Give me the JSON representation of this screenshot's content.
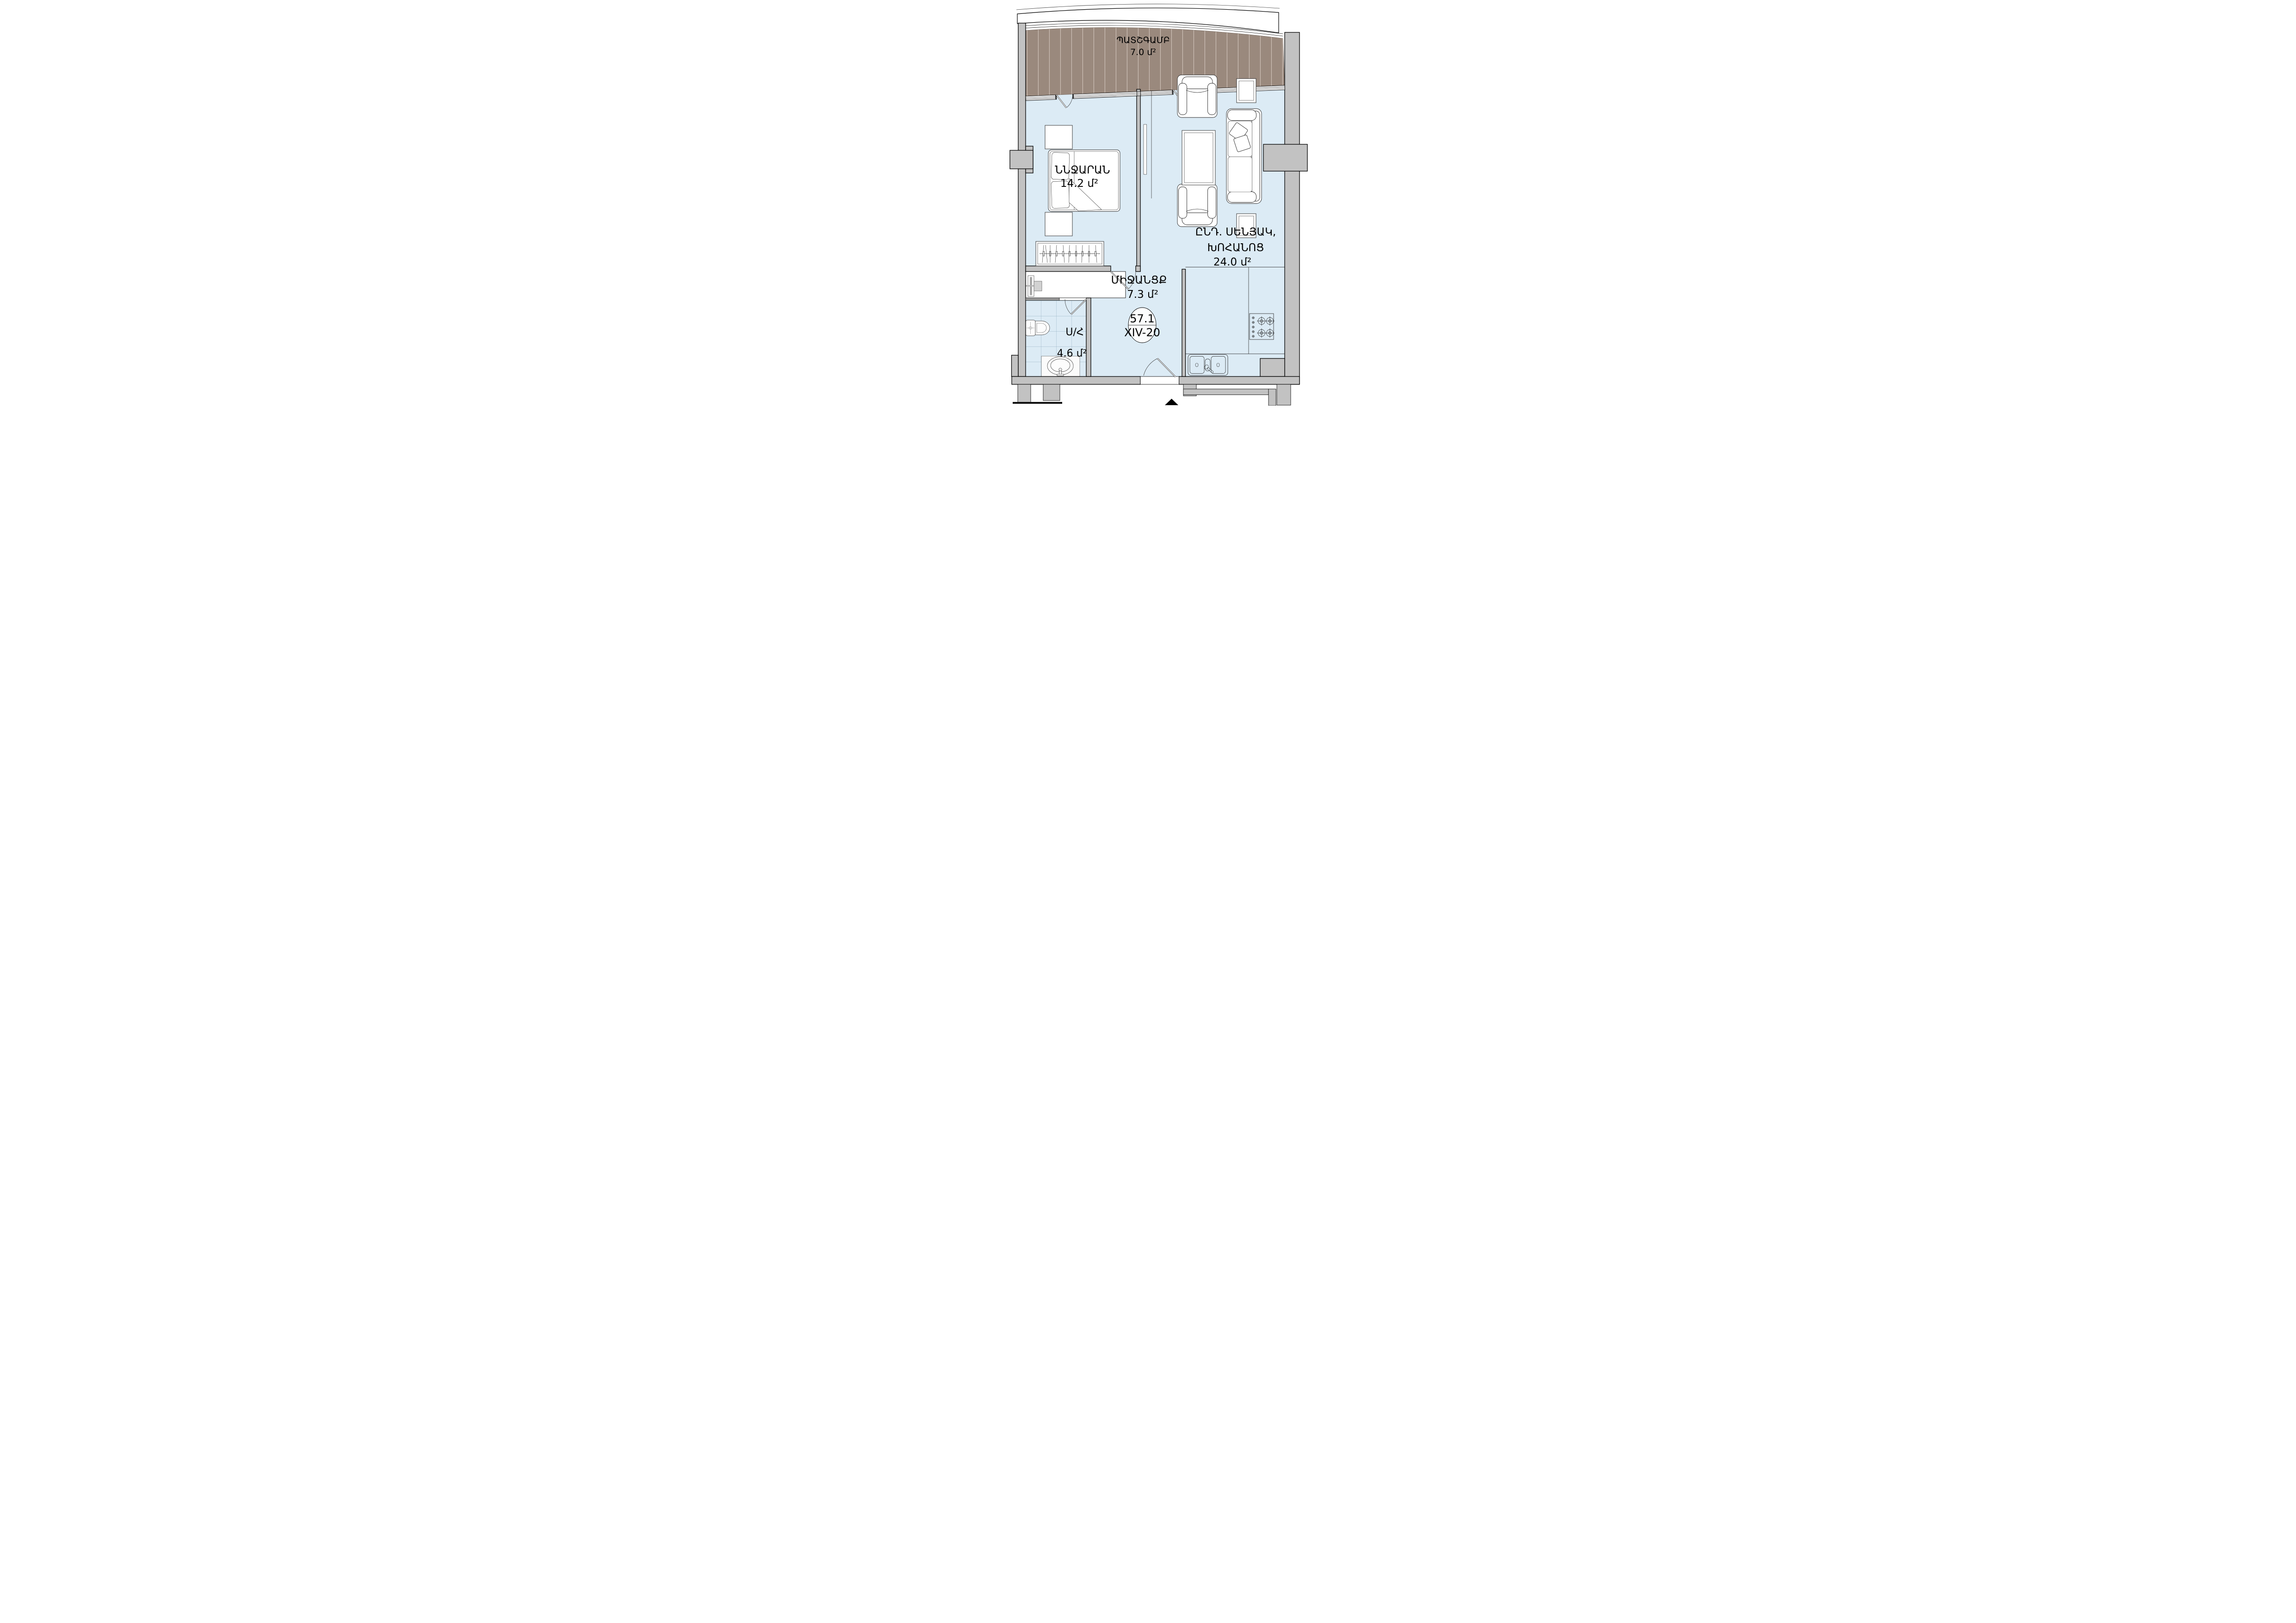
{
  "title": "Apartment floor plan",
  "rooms": {
    "balcony": {
      "name": "ՊԱՏՇԳԱՄԲ",
      "area": "7.0 մ²"
    },
    "bedroom": {
      "name": "ՆՆՋԱՐԱՆ",
      "area": "14.2 մ²"
    },
    "living_kitchen": {
      "name_line1": "ԸՆԴ. ՍԵՆՅԱԿ,",
      "name_line2": "ԽՈՀԱՆՈՑ",
      "area": "24.0 մ²"
    },
    "corridor": {
      "name": "ՄԻՋԱՆՑՔ",
      "area": "7.3 մ²"
    },
    "bathroom": {
      "name": "Ս/Հ",
      "area": "4.6 մ²"
    }
  },
  "unit_badge": {
    "total_area": "57.1",
    "unit_code": "XIV-20"
  },
  "colors": {
    "floor": "#dcebf5",
    "balcony_deck": "#9a897d",
    "wall": "#c2c2c2",
    "tile_line": "#7fa0b4"
  }
}
